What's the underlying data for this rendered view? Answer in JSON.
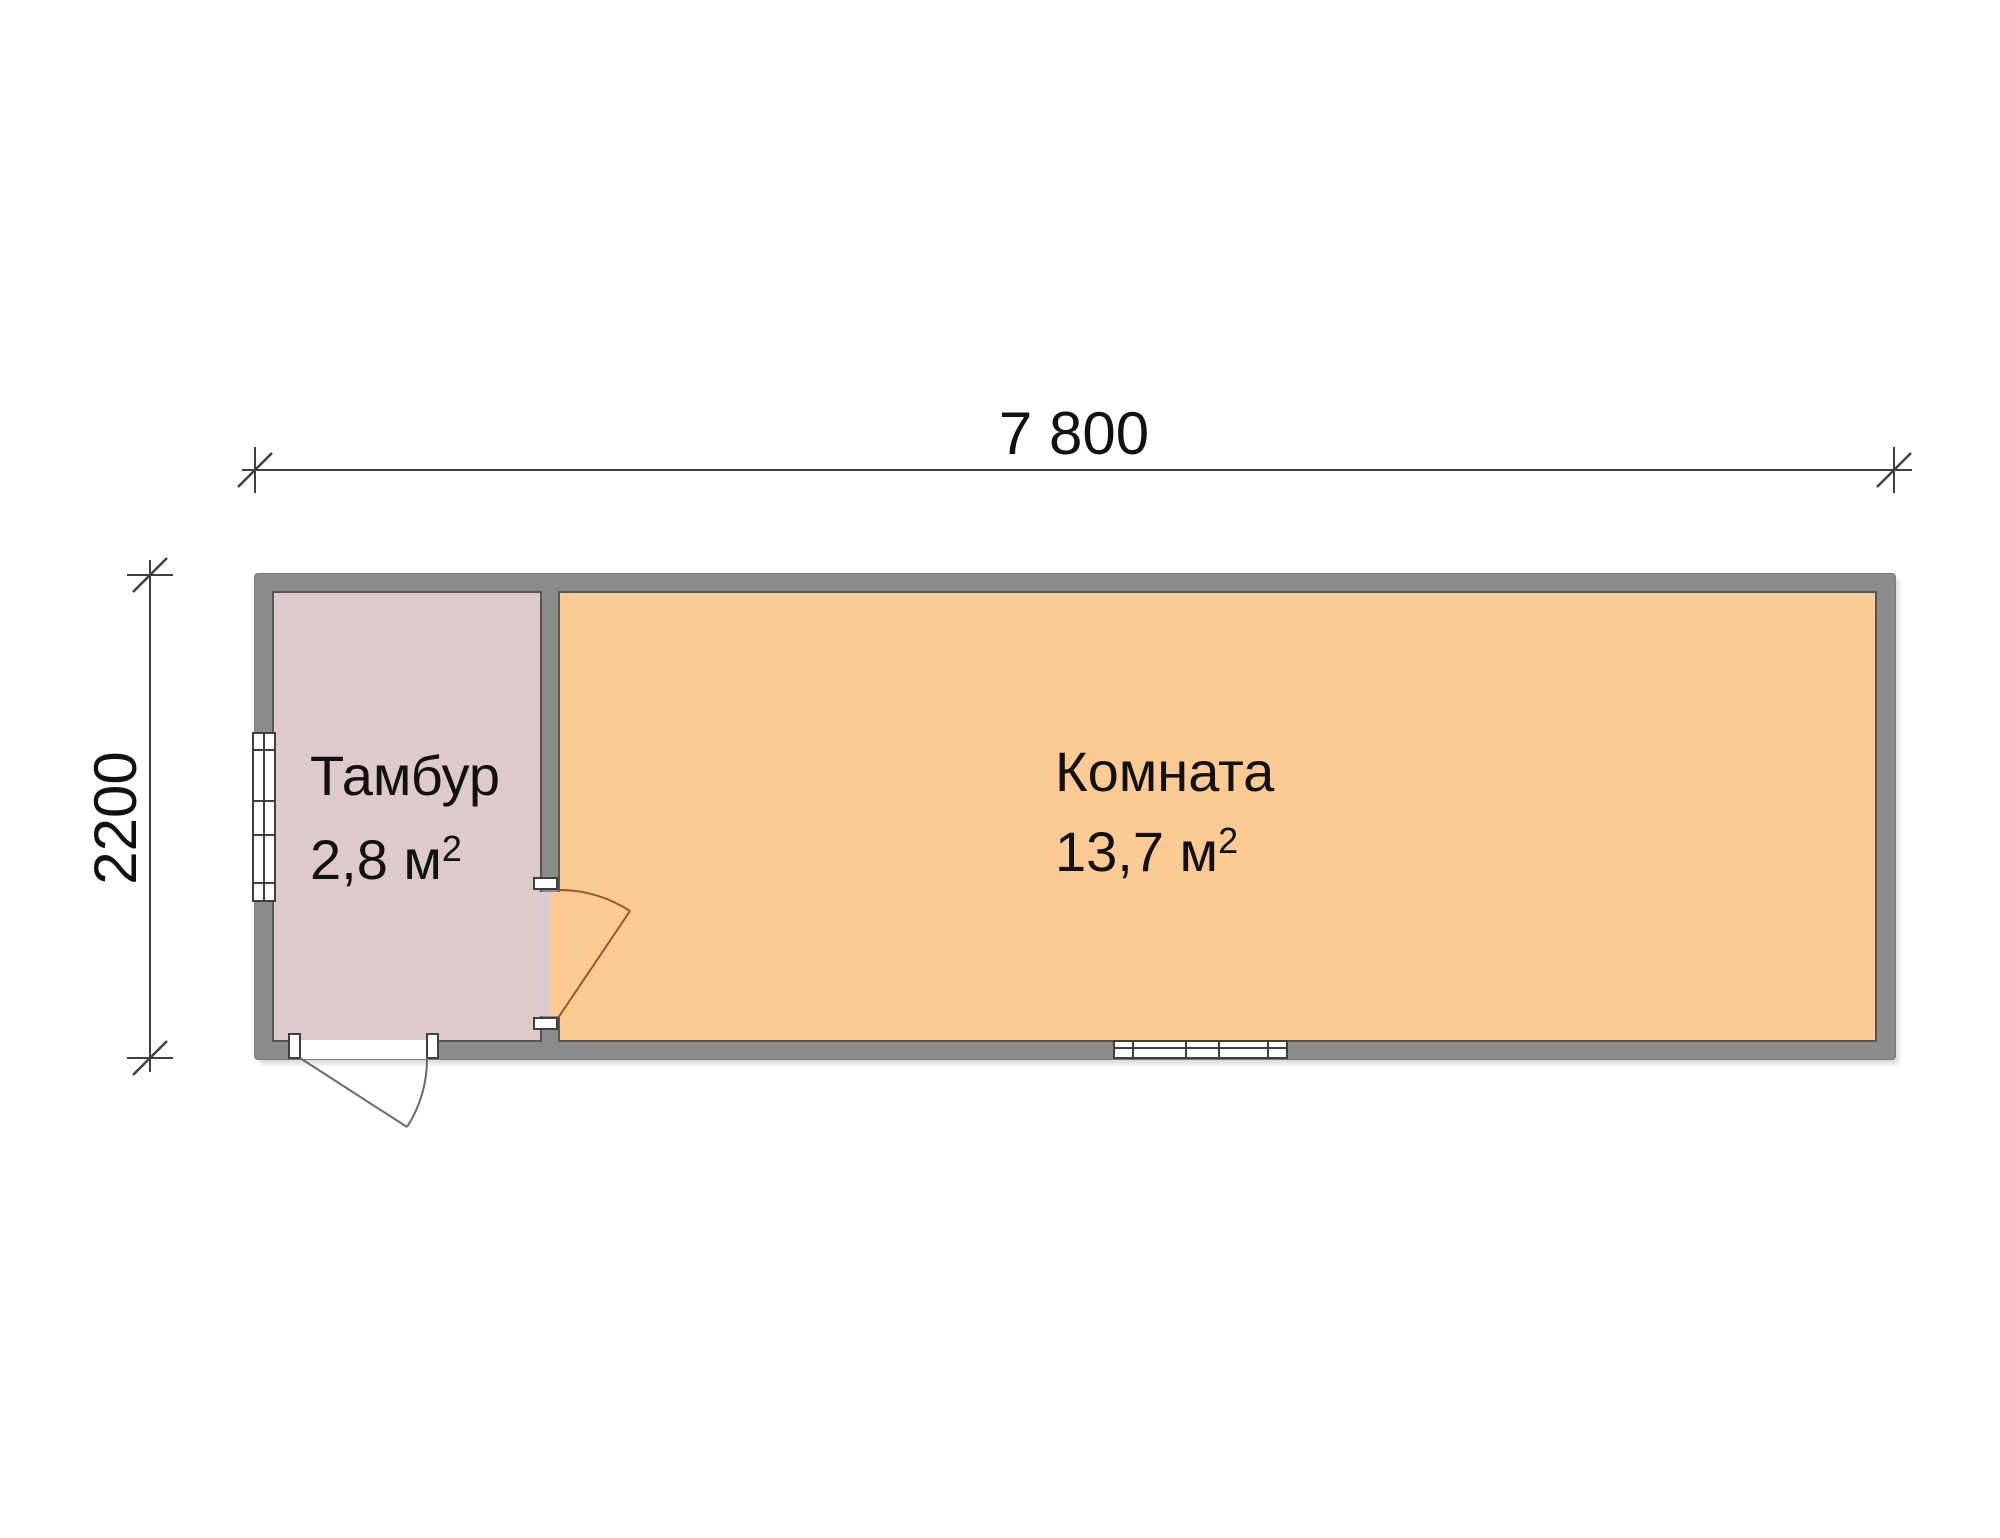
{
  "dimensions": {
    "width_label": "7 800",
    "height_label": "2200"
  },
  "rooms": {
    "vestibule": {
      "name": "Тамбур",
      "area": "2,8 м",
      "area_exponent": "2"
    },
    "main": {
      "name": "Комната",
      "area": "13,7 м",
      "area_exponent": "2"
    }
  },
  "colors": {
    "wall_fill": "#8B8B8B",
    "vestibule_fill": "#DDC9CE",
    "main_room_fill": "#FCCA95",
    "room_outline": "#565656",
    "dimension_line": "#3F3F3F",
    "exterior_door_line": "#6A6A6A",
    "interior_door_line": "#9B5526",
    "text": "#111111"
  }
}
